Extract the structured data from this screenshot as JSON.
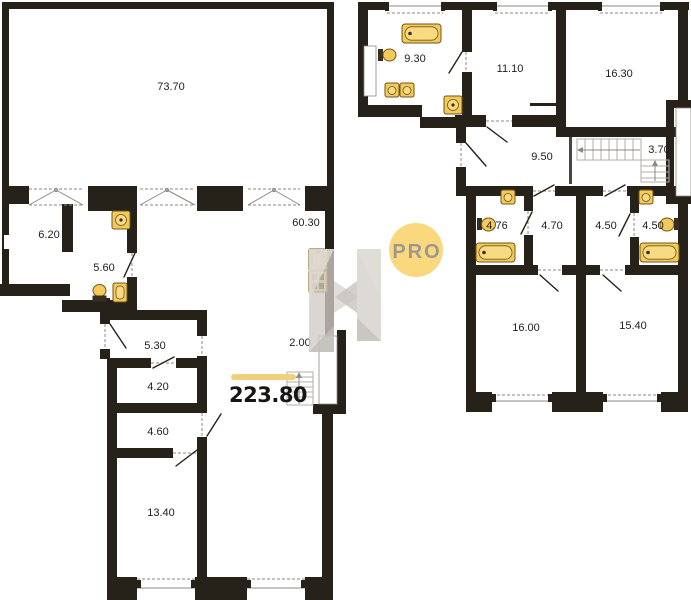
{
  "watermark": {
    "badge": "PRO"
  },
  "summary": {
    "total_area": "223.80"
  },
  "left_plan": {
    "name": "level-one",
    "rooms": [
      {
        "id": "great-room",
        "area": "73.70"
      },
      {
        "id": "room-a",
        "area": "6.20"
      },
      {
        "id": "bath-lobby",
        "area": "5.60"
      },
      {
        "id": "kitchen-living",
        "area": "60.30"
      },
      {
        "id": "corridor",
        "area": "5.30"
      },
      {
        "id": "store-1",
        "area": "4.20"
      },
      {
        "id": "store-2",
        "area": "4.60"
      },
      {
        "id": "bedroom",
        "area": "13.40"
      },
      {
        "id": "stair-void",
        "area": "2.00"
      }
    ]
  },
  "right_plan": {
    "name": "level-two",
    "rooms": [
      {
        "id": "bathroom-large",
        "area": "9.30"
      },
      {
        "id": "room-b",
        "area": "11.10"
      },
      {
        "id": "bedroom-c",
        "area": "16.30"
      },
      {
        "id": "hall",
        "area": "9.50"
      },
      {
        "id": "stairs",
        "area": "3.70"
      },
      {
        "id": "bathroom-1",
        "area": "4.76"
      },
      {
        "id": "wardrobe-1",
        "area": "4.70"
      },
      {
        "id": "wardrobe-2",
        "area": "4.50"
      },
      {
        "id": "bathroom-2",
        "area": "4.50"
      },
      {
        "id": "bedroom-d",
        "area": "16.00"
      },
      {
        "id": "bedroom-e",
        "area": "15.40"
      }
    ]
  },
  "icons": [
    "bathtub-icon",
    "toilet-icon",
    "sink-icon",
    "washing-machine-icon",
    "stove-icon",
    "kitchen-sink-icon",
    "stairs-icon",
    "window-icon",
    "door-icon"
  ],
  "colors": {
    "wall": "#262119",
    "fixture_fill": "#F4C95B",
    "fixture_stroke": "#6F5718",
    "fixture_inner": "#F8DA82",
    "accent_bar": "#F0D07A",
    "badge_bg": "#F9D87E",
    "badge_text": "#9C9890",
    "line_grey": "#8D8984",
    "stair_line": "#B3AFA8",
    "watermark_grey": "#CFCBC5",
    "label_color": "#22211F"
  }
}
